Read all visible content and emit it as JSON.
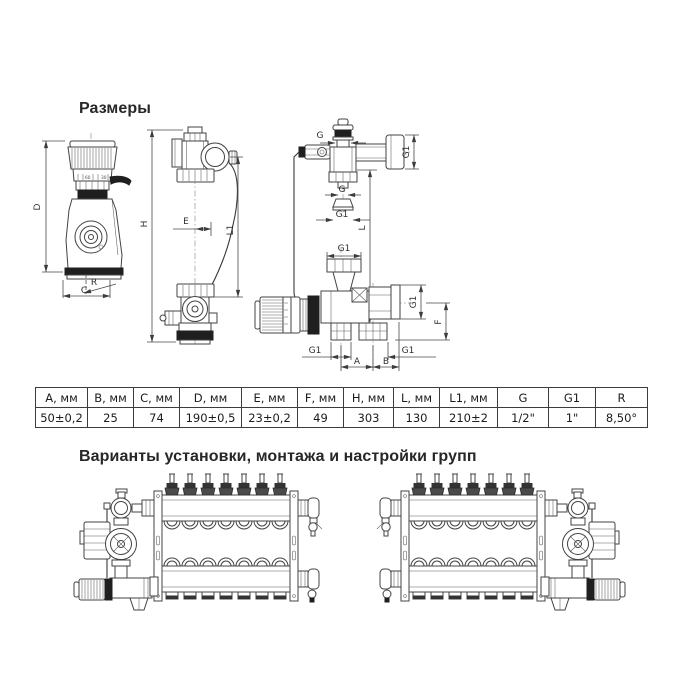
{
  "headings": {
    "dimensions": "Размеры",
    "variants": "Варианты установки, монтажа и настройки групп"
  },
  "labels": {
    "D": "D",
    "R": "R",
    "C": "C",
    "H": "H",
    "E": "E",
    "L1": "L1",
    "G_top": "G",
    "G1_flange": "G1",
    "G_union": "G",
    "G1_union": "G1",
    "L": "L",
    "G1_nut": "G1",
    "G1_port": "G1",
    "F": "F",
    "G1_bottom_left": "G1",
    "G1_bottom_right": "G1",
    "A": "A",
    "B": "B",
    "scale_60": "60",
    "scale_30": "30"
  },
  "table": {
    "headers": [
      "А, мм",
      "В, мм",
      "С, мм",
      "D, мм",
      "Е, мм",
      "F, мм",
      "Н, мм",
      "L, мм",
      "L1, мм",
      "G",
      "G1",
      "R"
    ],
    "values": [
      "50±0,2",
      "25",
      "74",
      "190±0,5",
      "23±0,2",
      "49",
      "303",
      "130",
      "210±2",
      "1/2\"",
      "1\"",
      "8,50°"
    ]
  }
}
